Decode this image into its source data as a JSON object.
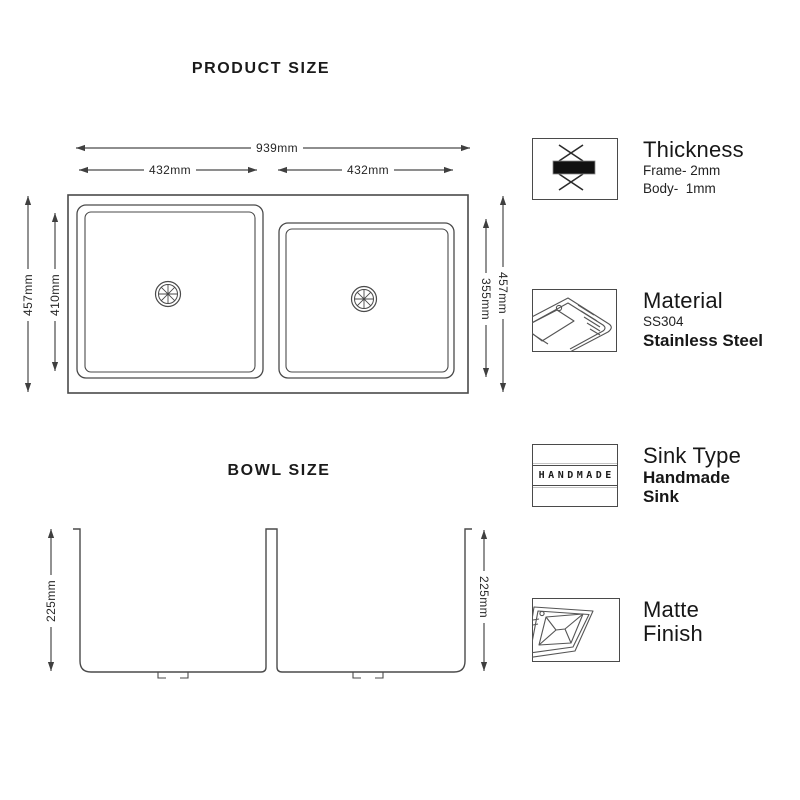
{
  "sections": {
    "product_size_title": "PRODUCT SIZE",
    "bowl_size_title": "BOWL SIZE"
  },
  "dimensions": {
    "overall_width": "939mm",
    "left_bowl_width": "432mm",
    "right_bowl_width": "432mm",
    "left_outer_height": "457mm",
    "left_bowl_height": "410mm",
    "right_bowl_height": "355mm",
    "right_outer_height": "457mm",
    "left_bowl_depth": "225mm",
    "right_bowl_depth": "225mm"
  },
  "features": [
    {
      "icon": "thickness-icon",
      "title": "Thickness",
      "line1": "Frame- 2mm",
      "line2": "Body-  1mm"
    },
    {
      "icon": "material-sink-icon",
      "title": "Material",
      "line1": "SS304",
      "bold1": "Stainless Steel"
    },
    {
      "icon": "handmade-badge-icon",
      "title": "Sink Type",
      "bold1": "Handmade",
      "bold2": "Sink",
      "band_text": "HANDMADE"
    },
    {
      "icon": "matte-finish-sink-icon",
      "title": "Matte",
      "title2": "Finish"
    }
  ],
  "colors": {
    "background": "#ffffff",
    "line": "#4a4a4a",
    "text": "#1e1e1e",
    "thickness_bar": "#111111"
  }
}
